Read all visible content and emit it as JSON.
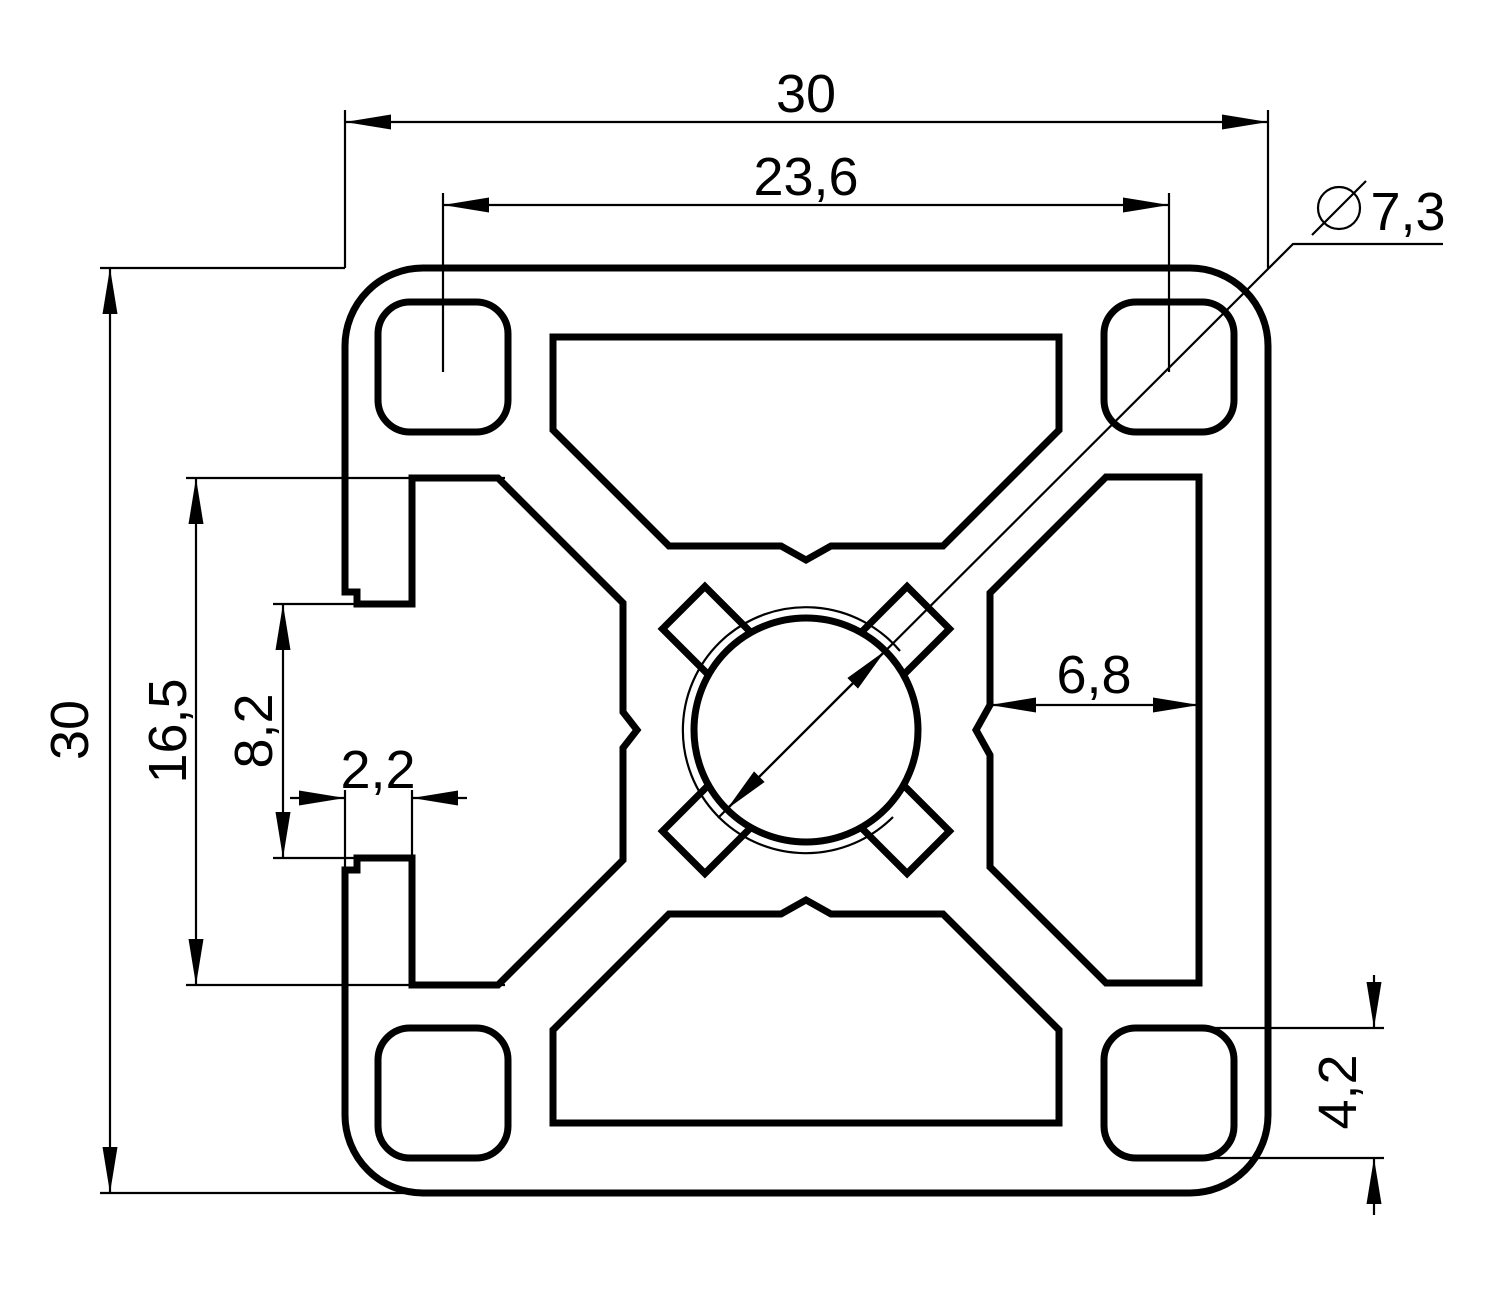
{
  "drawing": {
    "background": "#ffffff",
    "line_color": "#000000",
    "dimensions": {
      "overall_width": "30",
      "overall_height": "30",
      "corner_hole_spacing": "23,6",
      "center_bore_diameter": "7,3",
      "slot_cavity_depth": "16,5",
      "slot_opening_width": "8,2",
      "slot_lip_thickness": "2,2",
      "side_cavity_width": "6,8",
      "corner_hole_size": "4,2"
    }
  }
}
